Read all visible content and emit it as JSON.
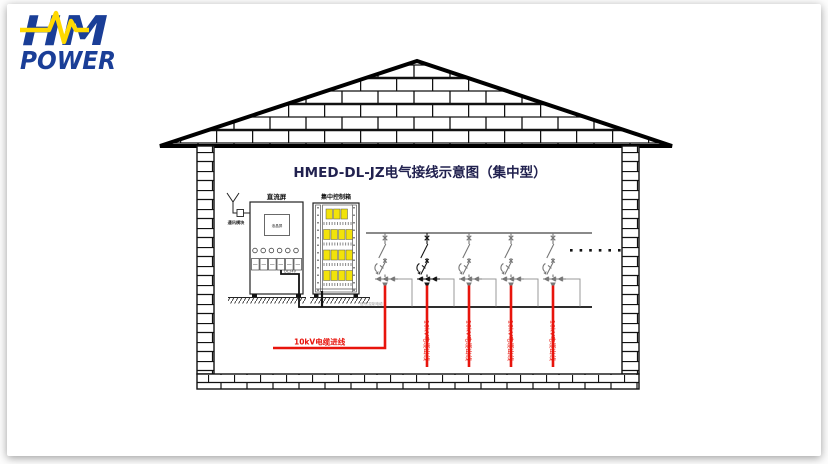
{
  "logo": {
    "hm": "HM",
    "power": "POWER"
  },
  "title": "HMED-DL-JZ电气接线示意图（集中型）",
  "diagram": {
    "antenna_label": "通讯模块",
    "dc_panel_label": "直流屏",
    "dc_screen_label": "液晶屏",
    "dc_cable_label": "DC24V",
    "control_box_label": "集中控制箱",
    "control_cable_note": "信号,控制电缆",
    "incoming_cable_label": "10kV电缆进线",
    "outgoing_cable_label": "10kV电缆出线",
    "branch_count": 5,
    "continuation_dots_count": 6
  },
  "colors": {
    "brand_navy": "#1a3e97",
    "brand_yellow": "#ffd900",
    "title_navy": "#21214f",
    "cable_red": "#e8140c",
    "module_yellow": "#f2e30a",
    "line_black": "#111111",
    "line_gray": "#777777"
  }
}
